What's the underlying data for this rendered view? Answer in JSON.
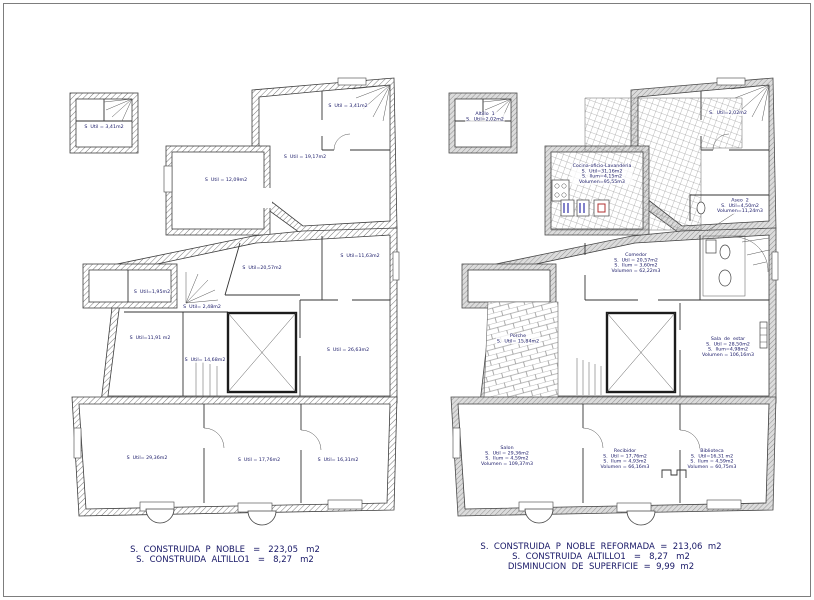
{
  "drawing": {
    "ink_color": "#171766",
    "wall_hatch_color": "#6a6a6a",
    "accent_marks": {
      "blue": "#2e2ea8",
      "red": "#b03030"
    }
  },
  "left_plan": {
    "labels": [
      {
        "x": 104,
        "y": 127,
        "lines": [
          "S  Util = 3,41m2"
        ]
      },
      {
        "x": 348,
        "y": 106,
        "lines": [
          "S  Util = 3,41m2"
        ]
      },
      {
        "x": 305,
        "y": 157,
        "lines": [
          "S  Util = 19,17m2"
        ]
      },
      {
        "x": 226,
        "y": 180,
        "lines": [
          "S  Util = 12,09m2"
        ]
      },
      {
        "x": 262,
        "y": 268,
        "lines": [
          "S  Util=20,57m2"
        ]
      },
      {
        "x": 360,
        "y": 256,
        "lines": [
          "S  Util=11,63m2"
        ]
      },
      {
        "x": 152,
        "y": 292,
        "lines": [
          "S  Util=1,95m2"
        ]
      },
      {
        "x": 202,
        "y": 307,
        "lines": [
          "S  Util= 2,48m2"
        ]
      },
      {
        "x": 150,
        "y": 338,
        "lines": [
          "S  Util=11,91 m2"
        ]
      },
      {
        "x": 205,
        "y": 360,
        "lines": [
          "S  Util= 14,68m2"
        ]
      },
      {
        "x": 348,
        "y": 350,
        "lines": [
          "S  Util = 26,63m2"
        ]
      },
      {
        "x": 147,
        "y": 458,
        "lines": [
          "S  Util= 29,36m2"
        ]
      },
      {
        "x": 259,
        "y": 460,
        "lines": [
          "S  Util = 17,76m2"
        ]
      },
      {
        "x": 338,
        "y": 460,
        "lines": [
          "S  Util= 16,31m2"
        ]
      }
    ],
    "summary": {
      "x": 225,
      "y": 545,
      "lines": [
        "S.  CONSTRUIDA  P  NOBLE   =   223,05   m2",
        "S.  CONSTRUIDA  ALTILLO1   =   8,27   m2"
      ]
    }
  },
  "right_plan": {
    "labels": [
      {
        "x": 485,
        "y": 117,
        "lines": [
          "Altillo  1",
          "S.  Util=2,02m2"
        ]
      },
      {
        "x": 728,
        "y": 113,
        "lines": [
          "S.  Util=2,02m2"
        ]
      },
      {
        "x": 602,
        "y": 174,
        "lines": [
          "Cocina-oficio-Lavanderia",
          "S.  Util=31,16m2",
          "S.  Ilum=4,15m2",
          "Volumen=95,55m3"
        ]
      },
      {
        "x": 740,
        "y": 206,
        "lines": [
          "Aseo  2",
          "S.  Util=4,50m2",
          "Volumen=11,24m3"
        ]
      },
      {
        "x": 636,
        "y": 263,
        "lines": [
          "Comedor",
          "S.  Util = 20,57m2",
          "S.  Ilum = 3,60m2",
          "Volumen = 62,22m3"
        ]
      },
      {
        "x": 728,
        "y": 347,
        "lines": [
          "Sala  de  estar",
          "S.  Util = 28,50m2",
          "S.  Ilum=4,98m2",
          "Volumen = 106,16m3"
        ]
      },
      {
        "x": 518,
        "y": 339,
        "lines": [
          "Porche",
          "S.  Util= 15,84m2"
        ]
      },
      {
        "x": 507,
        "y": 456,
        "lines": [
          "Salon",
          "S.  Util = 29,36m2",
          "S.  Ilum = 4,59m2",
          "Volumen = 109,37m3"
        ]
      },
      {
        "x": 625,
        "y": 459,
        "lines": [
          "Recibidor",
          "S.  Util = 17,76m2",
          "S.  Ilum = 4,93m2",
          "Volumen = 66,16m3"
        ]
      },
      {
        "x": 712,
        "y": 459,
        "lines": [
          "Biblioteca",
          "S.  Util=16,31 m2",
          "S.  Ilum = 4,59m2",
          "Volumen = 60,75m3"
        ]
      }
    ],
    "summary": {
      "x": 601,
      "y": 542,
      "lines": [
        "S.  CONSTRUIDA  P  NOBLE  REFORMADA  =  213,06  m2",
        "S.  CONSTRUIDA  ALTILLO1   =   8,27   m2",
        "DISMINUCION  DE  SUPERFICIE  =  9,99  m2"
      ]
    }
  }
}
